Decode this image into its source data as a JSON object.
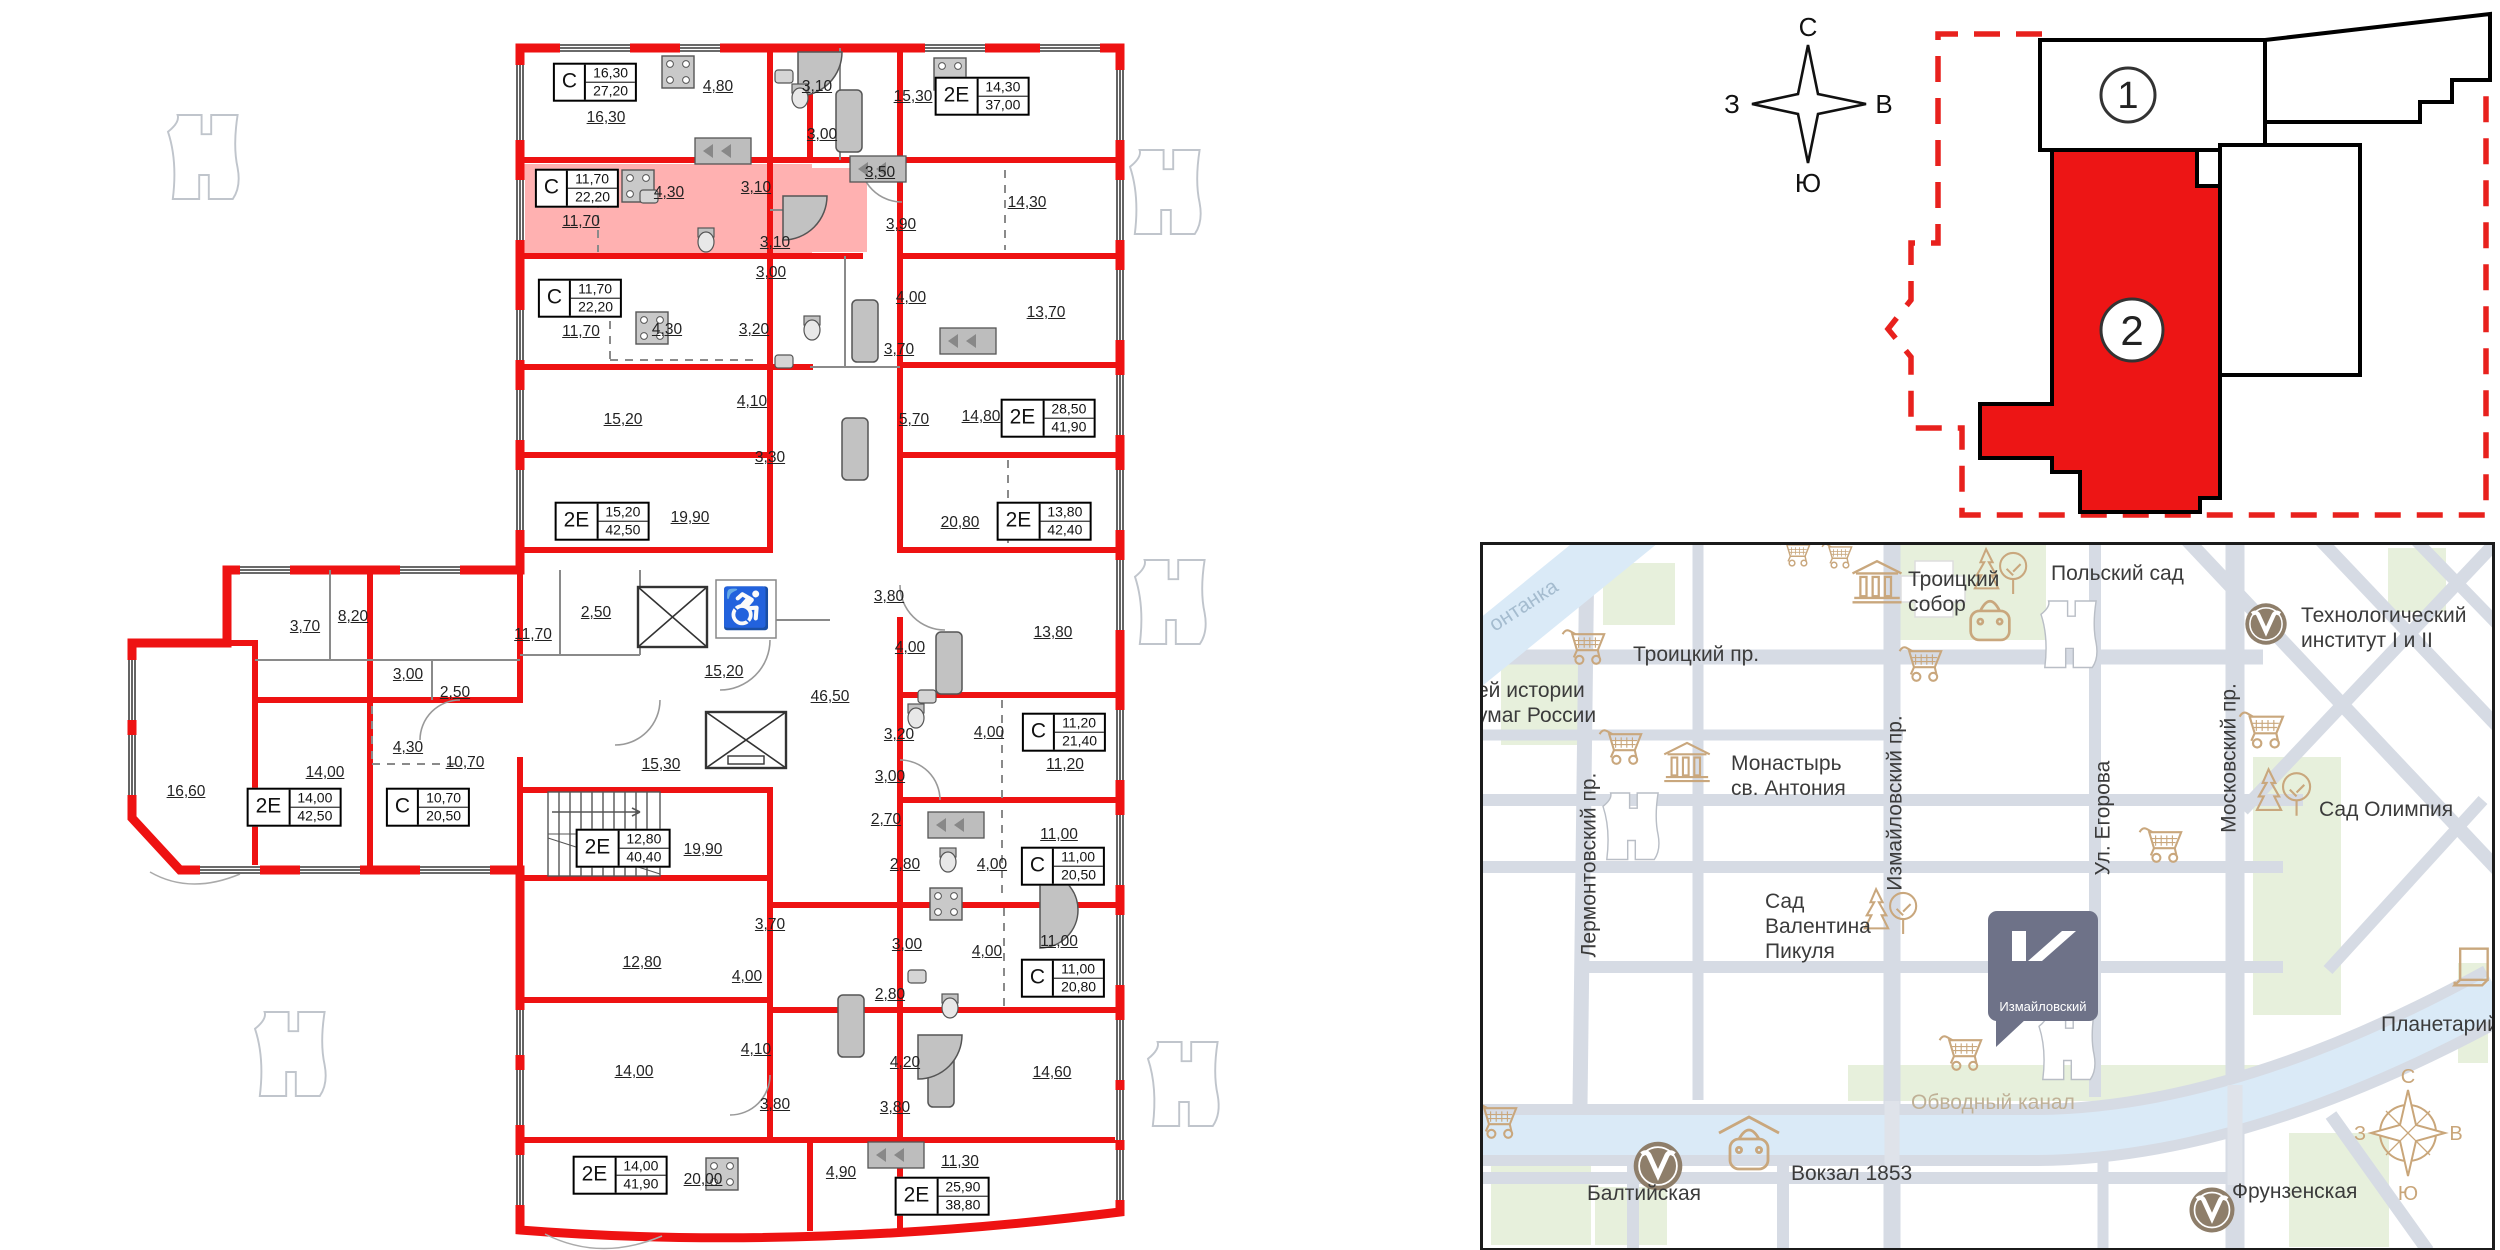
{
  "plan": {
    "wall_color": "#ee1212",
    "highlight_color": "rgba(255,70,70,0.42)",
    "rooms": [
      {
        "a": "16,30",
        "x": 606,
        "y": 118
      },
      {
        "a": "4,80",
        "x": 718,
        "y": 87
      },
      {
        "a": "3,10",
        "x": 817,
        "y": 87
      },
      {
        "a": "3,00",
        "x": 822,
        "y": 135
      },
      {
        "a": "15,30",
        "x": 913,
        "y": 97
      },
      {
        "a": "3,50",
        "x": 880,
        "y": 173
      },
      {
        "a": "14,30",
        "x": 1027,
        "y": 203
      },
      {
        "a": "3,90",
        "x": 901,
        "y": 225
      },
      {
        "a": "11,70",
        "x": 581,
        "y": 222
      },
      {
        "a": "4,30",
        "x": 669,
        "y": 193
      },
      {
        "a": "3,10",
        "x": 756,
        "y": 188
      },
      {
        "a": "3,10",
        "x": 775,
        "y": 243
      },
      {
        "a": "3,00",
        "x": 771,
        "y": 273
      },
      {
        "a": "11,70",
        "x": 581,
        "y": 332
      },
      {
        "a": "4,30",
        "x": 667,
        "y": 330
      },
      {
        "a": "3,20",
        "x": 754,
        "y": 330
      },
      {
        "a": "4,00",
        "x": 911,
        "y": 298
      },
      {
        "a": "13,70",
        "x": 1046,
        "y": 313
      },
      {
        "a": "3,70",
        "x": 899,
        "y": 350
      },
      {
        "a": "15,20",
        "x": 623,
        "y": 420
      },
      {
        "a": "4,10",
        "x": 752,
        "y": 402
      },
      {
        "a": "5,70",
        "x": 914,
        "y": 420
      },
      {
        "a": "14,80",
        "x": 981,
        "y": 417
      },
      {
        "a": "3,30",
        "x": 770,
        "y": 458
      },
      {
        "a": "19,90",
        "x": 690,
        "y": 518
      },
      {
        "a": "20,80",
        "x": 960,
        "y": 523
      },
      {
        "a": "2,50",
        "x": 596,
        "y": 613
      },
      {
        "a": "11,70",
        "x": 533,
        "y": 635
      },
      {
        "a": "15,20",
        "x": 724,
        "y": 672
      },
      {
        "a": "46,50",
        "x": 830,
        "y": 697
      },
      {
        "a": "3,80",
        "x": 889,
        "y": 597
      },
      {
        "a": "4,00",
        "x": 910,
        "y": 648
      },
      {
        "a": "13,80",
        "x": 1053,
        "y": 633
      },
      {
        "a": "15,30",
        "x": 661,
        "y": 765
      },
      {
        "a": "3,20",
        "x": 899,
        "y": 735
      },
      {
        "a": "4,00",
        "x": 989,
        "y": 733
      },
      {
        "a": "11,20",
        "x": 1065,
        "y": 765
      },
      {
        "a": "3,00",
        "x": 890,
        "y": 777
      },
      {
        "a": "3,70",
        "x": 305,
        "y": 627
      },
      {
        "a": "8,20",
        "x": 353,
        "y": 617
      },
      {
        "a": "3,00",
        "x": 408,
        "y": 675
      },
      {
        "a": "2,50",
        "x": 455,
        "y": 693
      },
      {
        "a": "16,60",
        "x": 186,
        "y": 792
      },
      {
        "a": "14,00",
        "x": 325,
        "y": 773
      },
      {
        "a": "4,30",
        "x": 408,
        "y": 748
      },
      {
        "a": "10,70",
        "x": 465,
        "y": 763
      },
      {
        "a": "19,90",
        "x": 703,
        "y": 850
      },
      {
        "a": "2,70",
        "x": 886,
        "y": 820
      },
      {
        "a": "2,80",
        "x": 905,
        "y": 865
      },
      {
        "a": "4,00",
        "x": 992,
        "y": 865
      },
      {
        "a": "11,00",
        "x": 1059,
        "y": 835
      },
      {
        "a": "3,70",
        "x": 770,
        "y": 925
      },
      {
        "a": "12,80",
        "x": 642,
        "y": 963
      },
      {
        "a": "4,00",
        "x": 747,
        "y": 977
      },
      {
        "a": "3,00",
        "x": 907,
        "y": 945
      },
      {
        "a": "4,00",
        "x": 987,
        "y": 952
      },
      {
        "a": "11,00",
        "x": 1059,
        "y": 942
      },
      {
        "a": "2,80",
        "x": 890,
        "y": 995
      },
      {
        "a": "14,00",
        "x": 634,
        "y": 1072
      },
      {
        "a": "4,10",
        "x": 756,
        "y": 1050
      },
      {
        "a": "4,20",
        "x": 905,
        "y": 1063
      },
      {
        "a": "14,60",
        "x": 1052,
        "y": 1073
      },
      {
        "a": "3,80",
        "x": 775,
        "y": 1105
      },
      {
        "a": "3,80",
        "x": 895,
        "y": 1108
      },
      {
        "a": "20,00",
        "x": 703,
        "y": 1180
      },
      {
        "a": "4,90",
        "x": 841,
        "y": 1173
      },
      {
        "a": "11,30",
        "x": 960,
        "y": 1162
      }
    ],
    "badges": [
      {
        "type": "С",
        "room": "16,30",
        "total": "27,20",
        "x": 595,
        "y": 82,
        "hl": false
      },
      {
        "type": "2Е",
        "room": "14,30",
        "total": "37,00",
        "x": 982,
        "y": 96,
        "hl": false
      },
      {
        "type": "С",
        "room": "11,70",
        "total": "22,20",
        "x": 577,
        "y": 188,
        "hl": true
      },
      {
        "type": "С",
        "room": "11,70",
        "total": "22,20",
        "x": 580,
        "y": 298,
        "hl": false
      },
      {
        "type": "2Е",
        "room": "28,50",
        "total": "41,90",
        "x": 1048,
        "y": 418,
        "hl": false
      },
      {
        "type": "2Е",
        "room": "15,20",
        "total": "42,50",
        "x": 602,
        "y": 521,
        "hl": false
      },
      {
        "type": "2Е",
        "room": "13,80",
        "total": "42,40",
        "x": 1044,
        "y": 521,
        "hl": false
      },
      {
        "type": "С",
        "room": "11,20",
        "total": "21,40",
        "x": 1064,
        "y": 732,
        "hl": false
      },
      {
        "type": "2Е",
        "room": "14,00",
        "total": "42,50",
        "x": 294,
        "y": 807,
        "hl": false
      },
      {
        "type": "С",
        "room": "10,70",
        "total": "20,50",
        "x": 428,
        "y": 807,
        "hl": false
      },
      {
        "type": "2Е",
        "room": "12,80",
        "total": "40,40",
        "x": 623,
        "y": 848,
        "hl": false
      },
      {
        "type": "С",
        "room": "11,00",
        "total": "20,50",
        "x": 1063,
        "y": 866,
        "hl": false
      },
      {
        "type": "С",
        "room": "11,00",
        "total": "20,80",
        "x": 1063,
        "y": 978,
        "hl": false
      },
      {
        "type": "2Е",
        "room": "14,00",
        "total": "41,90",
        "x": 620,
        "y": 1175,
        "hl": false
      },
      {
        "type": "2Е",
        "room": "25,90",
        "total": "38,80",
        "x": 942,
        "y": 1196,
        "hl": false
      }
    ]
  },
  "compass": {
    "north": "С",
    "south": "Ю",
    "west": "З",
    "east": "В"
  },
  "site_plan": {
    "section1": "1",
    "section2": "2",
    "highlight_color": "#ed1515"
  },
  "map": {
    "logo_text": "Измайловский",
    "compass": {
      "north": "С",
      "south": "Ю",
      "west": "З",
      "east": "В"
    },
    "labels": [
      {
        "text": "онтанка",
        "x": 2,
        "y": 48,
        "cls": "water"
      },
      {
        "text": "Троицкий пр.",
        "x": 150,
        "y": 97,
        "cls": ""
      },
      {
        "text": "ей истории\nумаг России",
        "x": -6,
        "y": 133,
        "cls": ""
      },
      {
        "text": "Троицкий\nсобор",
        "x": 425,
        "y": 22,
        "cls": ""
      },
      {
        "text": "Польский сад",
        "x": 568,
        "y": 16,
        "cls": ""
      },
      {
        "text": "Технологический\nинститут I и II",
        "x": 818,
        "y": 58,
        "cls": ""
      },
      {
        "text": "Монастырь\nсв. Антония",
        "x": 248,
        "y": 206,
        "cls": ""
      },
      {
        "text": "Лермонтовский пр.",
        "x": 106,
        "y": 320,
        "cls": "vert"
      },
      {
        "text": "Измайловский пр.",
        "x": 412,
        "y": 258,
        "cls": "vert"
      },
      {
        "text": "Ул. Егорова",
        "x": 620,
        "y": 273,
        "cls": "vert"
      },
      {
        "text": "Московский пр.",
        "x": 746,
        "y": 213,
        "cls": "vert"
      },
      {
        "text": "Сад Олимпия",
        "x": 836,
        "y": 252,
        "cls": ""
      },
      {
        "text": "Сад\nВалентина\nПикуля",
        "x": 282,
        "y": 344,
        "cls": ""
      },
      {
        "text": "Обводный канал",
        "x": 428,
        "y": 545,
        "cls": "canal"
      },
      {
        "text": "Балтийская",
        "x": 104,
        "y": 636,
        "cls": ""
      },
      {
        "text": "Вокзал 1853",
        "x": 308,
        "y": 616,
        "cls": ""
      },
      {
        "text": "Фрунзенская",
        "x": 749,
        "y": 634,
        "cls": ""
      },
      {
        "text": "Планетарий",
        "x": 898,
        "y": 467,
        "cls": ""
      }
    ],
    "icons": [
      {
        "type": "cart",
        "x": 78,
        "y": 78,
        "s": 48
      },
      {
        "type": "cart",
        "x": 115,
        "y": 178,
        "s": 48
      },
      {
        "type": "cart",
        "x": 415,
        "y": 95,
        "s": 48
      },
      {
        "type": "cart",
        "x": 755,
        "y": 160,
        "s": 50
      },
      {
        "type": "cart",
        "x": 655,
        "y": 276,
        "s": 48
      },
      {
        "type": "cart",
        "x": 455,
        "y": 484,
        "s": 48
      },
      {
        "type": "cart",
        "x": -10,
        "y": 552,
        "s": 48
      },
      {
        "type": "cart",
        "x": 296,
        "y": -8,
        "s": 34
      },
      {
        "type": "cart",
        "x": 338,
        "y": -6,
        "s": 34
      },
      {
        "type": "temple",
        "x": 366,
        "y": 12,
        "s": 56
      },
      {
        "type": "temple",
        "x": 178,
        "y": 194,
        "s": 52
      },
      {
        "type": "metro",
        "x": 760,
        "y": 56,
        "s": 46
      },
      {
        "type": "metro",
        "x": 148,
        "y": 594,
        "s": 54
      },
      {
        "type": "metro",
        "x": 704,
        "y": 640,
        "s": 50
      },
      {
        "type": "bag",
        "x": 478,
        "y": 50,
        "s": 58
      },
      {
        "type": "bagroof",
        "x": 234,
        "y": 568,
        "s": 64
      },
      {
        "type": "trees",
        "x": 490,
        "y": 0,
        "s": 56
      },
      {
        "type": "trees",
        "x": 772,
        "y": 220,
        "s": 58
      },
      {
        "type": "trees",
        "x": 380,
        "y": 340,
        "s": 56
      },
      {
        "type": "box",
        "x": 968,
        "y": 400,
        "s": 44
      }
    ]
  }
}
